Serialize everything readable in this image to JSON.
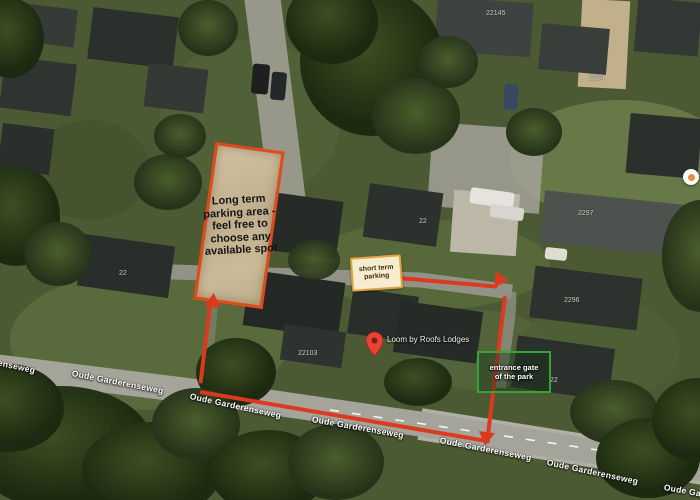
{
  "map": {
    "street_name": "Oude Garderenseweg",
    "street_labels": [
      {
        "text": "Oude Garderenseweg"
      },
      {
        "text": "Oude Garderenseweg"
      },
      {
        "text": "Oude Garderenseweg"
      },
      {
        "text": "Oude Garderenseweg"
      },
      {
        "text": "Oude Garderenseweg"
      },
      {
        "text": "Oude Garderenseweg"
      },
      {
        "text": "Oude Garderenseweg"
      }
    ],
    "house_numbers": [
      {
        "value": "22145"
      },
      {
        "value": "2294"
      },
      {
        "value": "2297"
      },
      {
        "value": "22"
      },
      {
        "value": "22"
      },
      {
        "value": "2296"
      },
      {
        "value": "22103"
      },
      {
        "value": "22"
      }
    ]
  },
  "annotations": {
    "long_term_parking": {
      "lines": [
        "Long term",
        "parking area -",
        "feel free to",
        "choose any",
        "available spot"
      ],
      "border_color": "#e2491b",
      "fill_color": "#c8b794"
    },
    "short_term_parking": {
      "lines": [
        "short term",
        "parking"
      ],
      "border_color": "#e2a33c",
      "fill_color": "#f6ecd0"
    },
    "entrance_gate": {
      "lines": [
        "entrance gate",
        "of the park"
      ],
      "border_color": "#36a336"
    },
    "route_color": "#dc3a1f"
  },
  "pin": {
    "label": "Loom by Roofs Lodges",
    "color": "#ea4335"
  }
}
